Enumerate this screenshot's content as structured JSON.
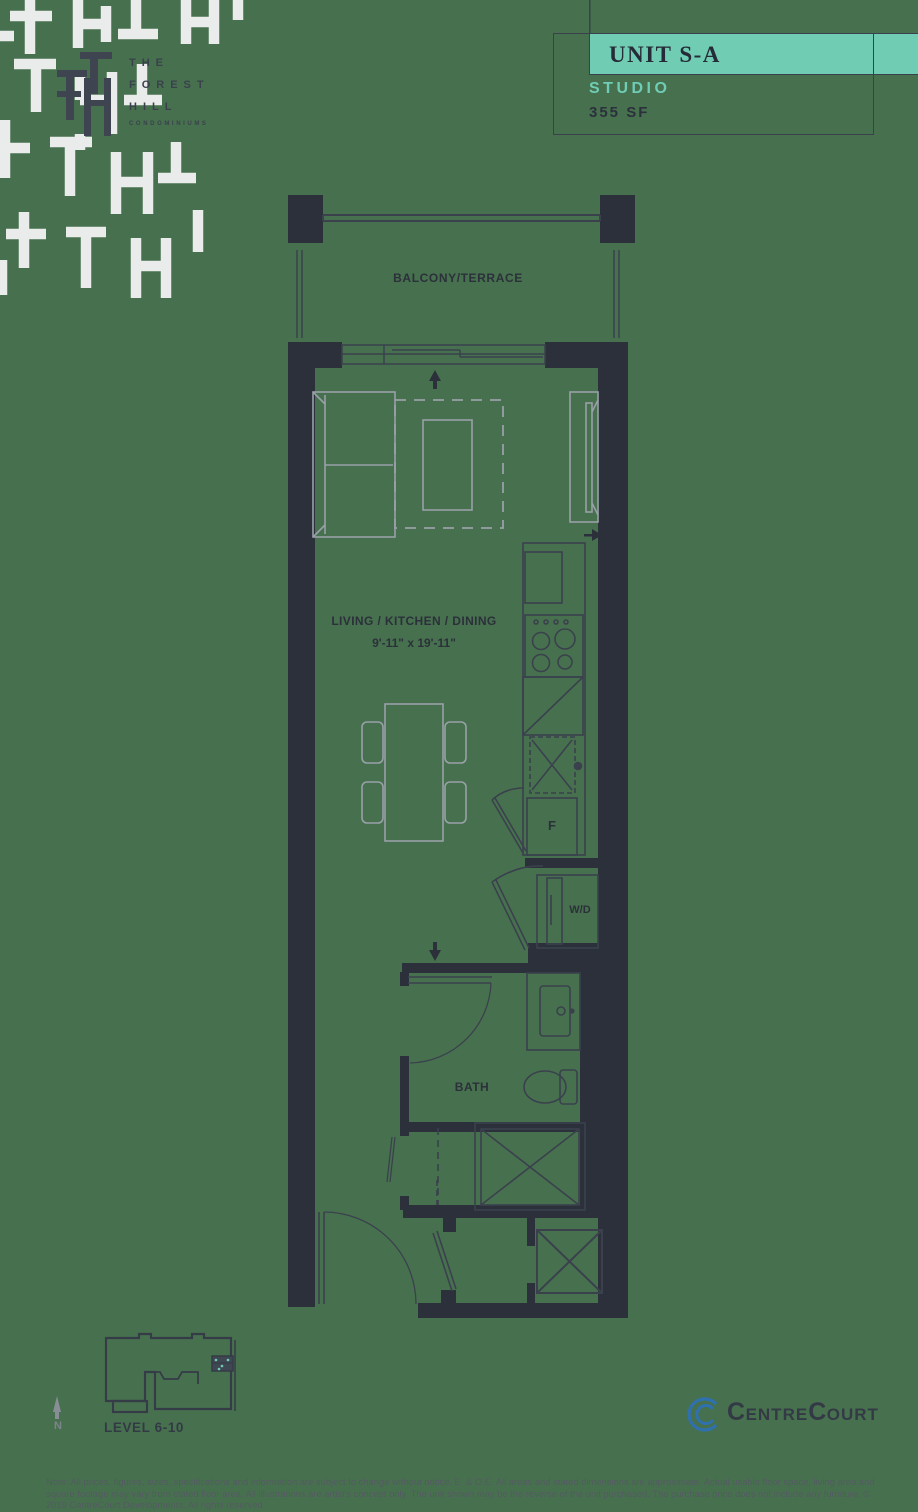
{
  "colors": {
    "background": "#47714E",
    "ink": "#3A414D",
    "wall": "#2B303A",
    "accent_teal": "#70CDB4",
    "furniture_gray": "#98A0A8",
    "logo_blue": "#2F70AE",
    "muted_text": "#545A63"
  },
  "brand": {
    "line1": "THE",
    "line2": "FOREST",
    "line3": "HILL",
    "tagline": "CONDOMINIUMS"
  },
  "title_block": {
    "unit_name": "UNIT S-A",
    "unit_type": "STUDIO",
    "unit_area": "355 SF"
  },
  "plan": {
    "balcony_label": "BALCONY/TERRACE",
    "living_label": "LIVING / KITCHEN / DINING",
    "living_dims": "9'-11\" x 19'-11\"",
    "fridge_label": "F",
    "washer_dryer_label": "W/D",
    "bath_label": "BATH"
  },
  "key_plan": {
    "level_label": "LEVEL 6-10",
    "north_label": "N"
  },
  "footer": {
    "logo_c1": "C",
    "logo_part1": "ENTRE",
    "logo_c2": "C",
    "logo_part2": "OURT",
    "disclaimer": "Note: All prices, figures, sizes, specifications and information are subject to change without notice. E. & O.E. All areas and stated dimensions are approximate. Actual usable floor space, living area and square footage may vary from stated floor area. All illustrations are artist's concept only. The unit shown may be the reverse of the unit purchased. The purchase price does not include any furniture. © 2019 CentreCourt Developments. All rights reserved."
  }
}
